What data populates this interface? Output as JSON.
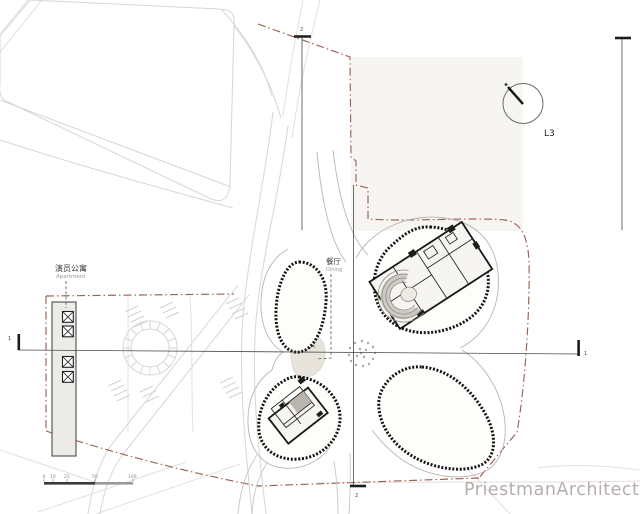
{
  "plan": {
    "watermark": "PriestmanArchitects",
    "north": {
      "label": "L3"
    },
    "labels": {
      "apartment_zh": "演员公寓",
      "apartment_en": "Apartment",
      "dining_zh": "餐厅",
      "dining_en": "Dining"
    },
    "sections": {
      "s1_left": "1",
      "s1_right": "1",
      "s2_top": "2",
      "s2_bottom": "2"
    },
    "scale_bar": {
      "ticks": [
        "0",
        "10",
        "25",
        "50",
        "100"
      ]
    },
    "colors": {
      "boundary": "#9c6055",
      "tree_line": "#141414",
      "road": "#d9d5d2",
      "paving": "#e8e4dc",
      "building_fill": "#f7f5f1",
      "core_gray": "#bab6ae",
      "ink": "#3a3a3a",
      "watermark": "#b5aeab"
    }
  }
}
